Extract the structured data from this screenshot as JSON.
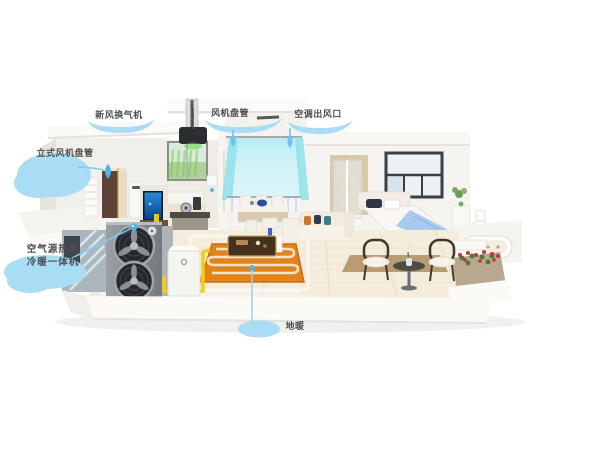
{
  "illustration": {
    "type": "annotated-cutaway-home-hvac-diagram",
    "callouts": {
      "fresh_air_unit": {
        "label": "新风换气机"
      },
      "fan_coil": {
        "label": "风机盘管"
      },
      "air_outlet": {
        "label": "空调出风口"
      },
      "floor_standing_fan_coil": {
        "label": "立式风机盘管"
      },
      "heat_pump_line1": {
        "label": "空气源热泵"
      },
      "heat_pump_line2": {
        "label": "冷暖一体机"
      },
      "floor_heating": {
        "label": "地暖"
      }
    },
    "colors": {
      "callout_bubble": "#a9dcf5",
      "callout_line": "#7ec8ee",
      "callout_dot": "#4fb2e8",
      "label_text": "#4f4f4f",
      "pipe_yellow": "#f2cf0e",
      "floor_heating_orange": "#e2831c",
      "curtain_cyan": "#9fe4f0",
      "airflow_green": "#6dd44a",
      "heat_pump_gray": "#84898e",
      "tv_screen_blue": "#1f6fc4",
      "blanket_blue": "#a9c9ef",
      "flower_red": "#c0392b",
      "background": "#ffffff"
    }
  }
}
